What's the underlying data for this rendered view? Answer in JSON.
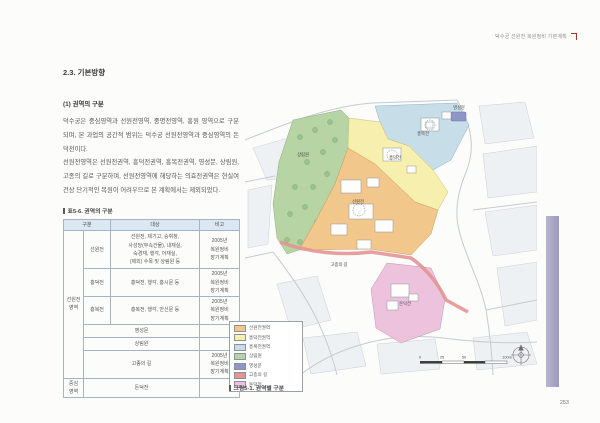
{
  "page": {
    "header_title": "덕수궁 선원전 복원정비 기본계획",
    "page_number": "253"
  },
  "article": {
    "section_title": "2.3. 기본방향",
    "subsection_title": "(1) 권역의 구분",
    "paragraph_1": "덕수궁은 중심영역과 선원전영역, 중명전영역, 홍원 영역으로 구분되며, 본 과업의 공간적 범위는 덕수궁 선원전영역과 중심영역의 돈덕전이다.",
    "paragraph_2": "선원전영역은 선원전권역, 흥덕전권역, 흥복전권역, 영성문, 상림원, 고종의 길로 구분하며, 선원전영역에 해당하는 의효전권역은 현실여건상 단기적인 복원이 어려우므로 본 계획에서는 제외되었다."
  },
  "table": {
    "caption": "표5-6. 권역의 구분",
    "headers": {
      "col_group": "구분",
      "col_target": "대상",
      "col_note": "비고"
    },
    "group_labels": {
      "seonwonjeon_area": "선원전\n영역",
      "central_area": "중심\n영역"
    },
    "rows": [
      {
        "name": "선원전",
        "target": "선원전, 제기고, 승휘청,\n사성당(부속건물), 내재실,\n숙경재, 행각, 어재실,\n(제외) 수목 및 상림원 등",
        "note": "2005년\n복원정비\n장기계획"
      },
      {
        "name": "흥덕전",
        "target": "흥덕전, 행각, 흥시문 등",
        "note": "2005년\n복원정비\n장기계획"
      },
      {
        "name": "흥복전",
        "target": "흥복전, 행각, 안신문 등",
        "note": "2005년\n복원정비\n장기계획"
      },
      {
        "name": "영성문",
        "target": "",
        "note": ""
      },
      {
        "name": "상림원",
        "target": "",
        "note": ""
      },
      {
        "name": "고종의 길",
        "target": "",
        "note": "2005년\n복원정비\n장기계획"
      },
      {
        "name": "돈덕전",
        "target": "",
        "note": ""
      }
    ]
  },
  "figure": {
    "caption": "그림5-1. 권역별 구분",
    "legend": [
      {
        "key": "seonwonjeon",
        "label": "선원전권역",
        "color": "#f2c78c"
      },
      {
        "key": "heungdeokjeon",
        "label": "흥덕전권역",
        "color": "#f6efad"
      },
      {
        "key": "heungbokjeon",
        "label": "흥복전권역",
        "color": "#c7dee8"
      },
      {
        "key": "sangnimwon",
        "label": "상림원",
        "color": "#b6d4a4"
      },
      {
        "key": "yeongseongmun",
        "label": "영성문",
        "color": "#8e96c6"
      },
      {
        "key": "gojong_road",
        "label": "고종의 길",
        "color": "#e39593"
      },
      {
        "key": "dondeokjeon",
        "label": "돈덕전",
        "color": "#edc2dd"
      }
    ],
    "map_labels": {
      "yeongseongmun": "영성문",
      "heungbokjeon": "흥복전",
      "heungdeokjeon": "흥덕전",
      "seonwonjeon": "선원전",
      "sangnimwon": "상림원",
      "dondeokjeon": "돈덕전",
      "gojong_road": "고종의 길"
    },
    "scale_labels": {
      "t0": "0",
      "t1": "25",
      "t2": "50",
      "t3": "100m"
    }
  }
}
